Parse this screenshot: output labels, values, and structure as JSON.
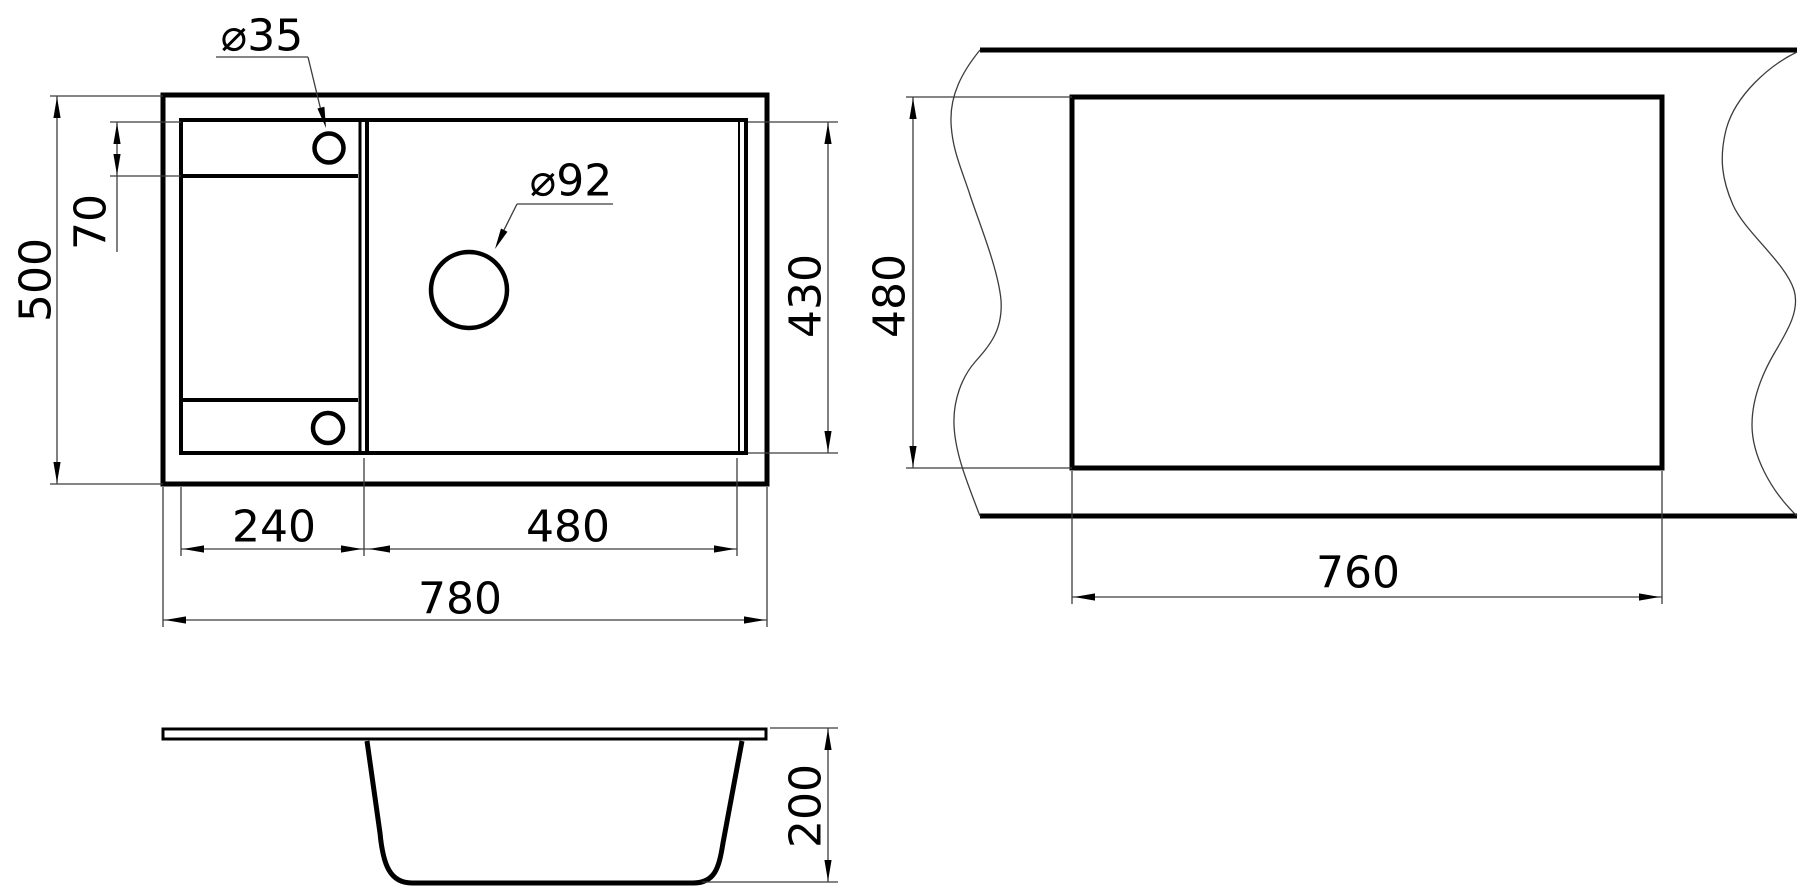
{
  "drawing": {
    "type": "sink-technical-drawing",
    "top_view": {
      "hole_small_label": "⌀35",
      "hole_faucet_label": "⌀92",
      "overall_height": "500",
      "rim_offset": "70",
      "inner_height": "430",
      "left_section_width": "240",
      "bowl_width": "480",
      "overall_width": "780"
    },
    "cutout_view": {
      "cut_height": "480",
      "cut_width": "760"
    },
    "section_view": {
      "depth": "200"
    },
    "colors": {
      "outline": "#000000",
      "dimension_line": "#3c3c3c",
      "background": "#ffffff"
    }
  }
}
